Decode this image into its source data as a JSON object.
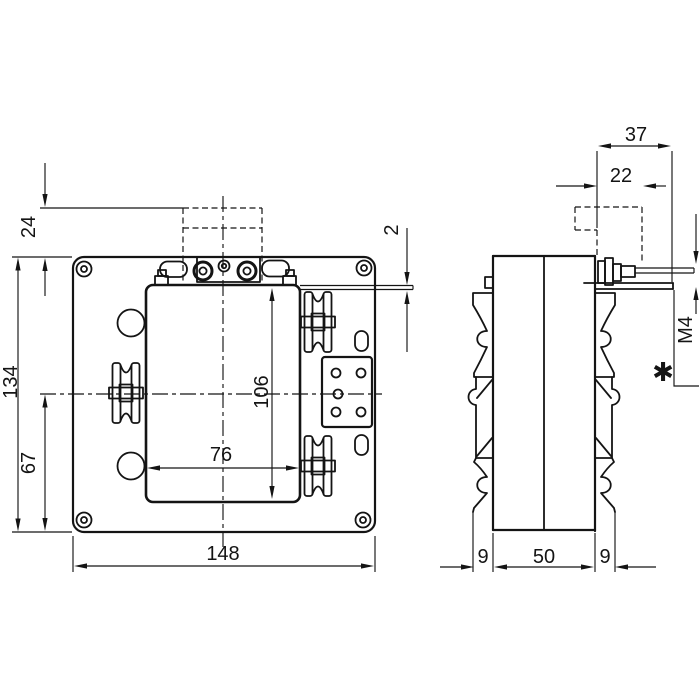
{
  "front_view": {
    "dims": {
      "top_offset": "24",
      "overall_height": "134",
      "center_to_bottom": "67",
      "window_width": "76",
      "window_height": "106",
      "overall_width": "148",
      "busbar_thickness": "2"
    }
  },
  "side_view": {
    "dims": {
      "bracket_projection": "37",
      "cover_projection": "22",
      "terminal_screw_thread": "M4",
      "front_flange_depth": "9",
      "body_depth": "50",
      "rear_flange_depth": "9"
    },
    "footnote_marker": "✱"
  },
  "colors": {
    "line": "#141414",
    "background": "#ffffff"
  }
}
